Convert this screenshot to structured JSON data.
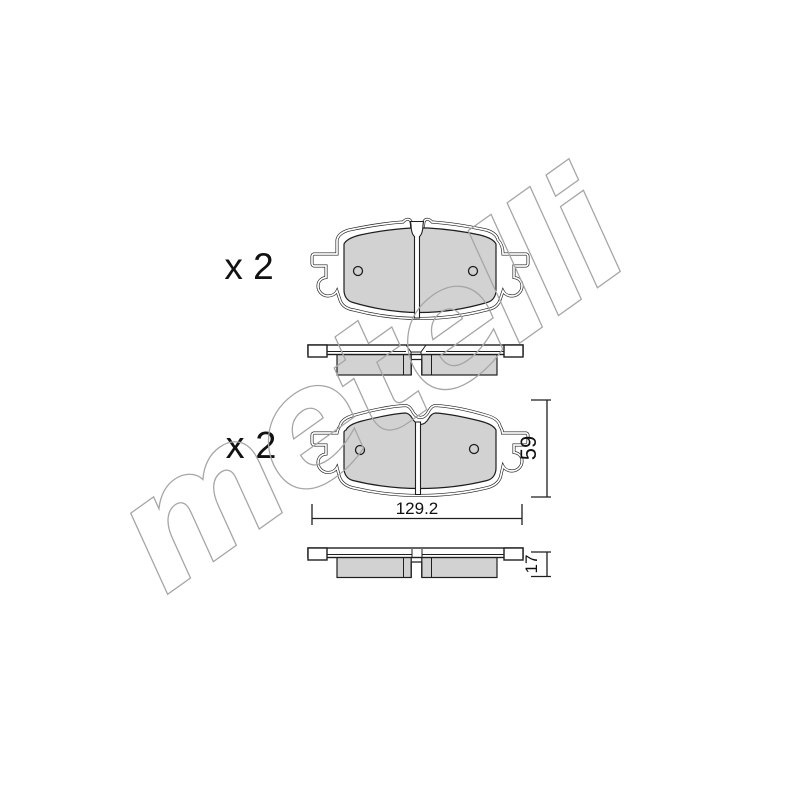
{
  "image": {
    "kind": "brake-pad-set-technical-drawing",
    "background": "#ffffff",
    "line_color": "#1f1f1f",
    "pad_fill": "#d2d2d2",
    "plate_fill": "#ffffff",
    "watermark": {
      "text": "metelli",
      "color": "#a6a6a6"
    }
  },
  "annotations": {
    "qty_top": "x 2",
    "qty_bottom": "x 2",
    "dim_width": "129.2",
    "dim_height": "59",
    "dim_thickness": "17"
  }
}
